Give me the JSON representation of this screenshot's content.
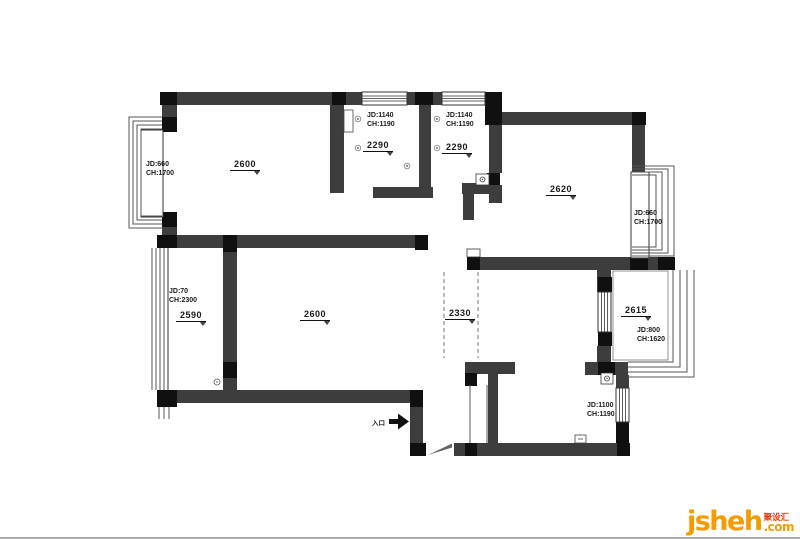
{
  "canvas": {
    "bottom_rule_color": "#aaaaaa",
    "background": "#ffffff"
  },
  "floorplan": {
    "entrance_label": "入口",
    "rooms": {
      "master_bedroom": {
        "dim": "2600"
      },
      "mid_room_1": {
        "jd": "JD:1140",
        "ch": "CH:1190",
        "dim": "2290"
      },
      "mid_room_2": {
        "jd": "JD:1140",
        "ch": "CH:1190",
        "dim": "2290"
      },
      "right_bedroom": {
        "dim": "2620"
      },
      "left_balcony": {
        "jd": "JD:70",
        "ch": "CH:2300",
        "dim": "2590"
      },
      "living_room": {
        "dim": "2600"
      },
      "passage_opening": {
        "dim": "2330"
      },
      "right_balcony": {
        "dim": "2615",
        "jd": "JD:800",
        "ch": "CH:1620"
      }
    },
    "windows": {
      "left_bay_window": {
        "jd": "JD:660",
        "ch": "CH:1700"
      },
      "right_bay_window": {
        "jd": "JD:660",
        "ch": "CH:1700"
      },
      "bottom_right_window": {
        "jd": "JD:1100",
        "ch": "CH:1190"
      }
    },
    "colors": {
      "wall": "#3d3d3d",
      "wall_dark": "#111111"
    }
  },
  "watermark": {
    "brand": "jsheh",
    "badge": "聚设汇",
    "tld": ".com",
    "brand_color": "#f59b00",
    "badge_color": "#e8380d"
  }
}
